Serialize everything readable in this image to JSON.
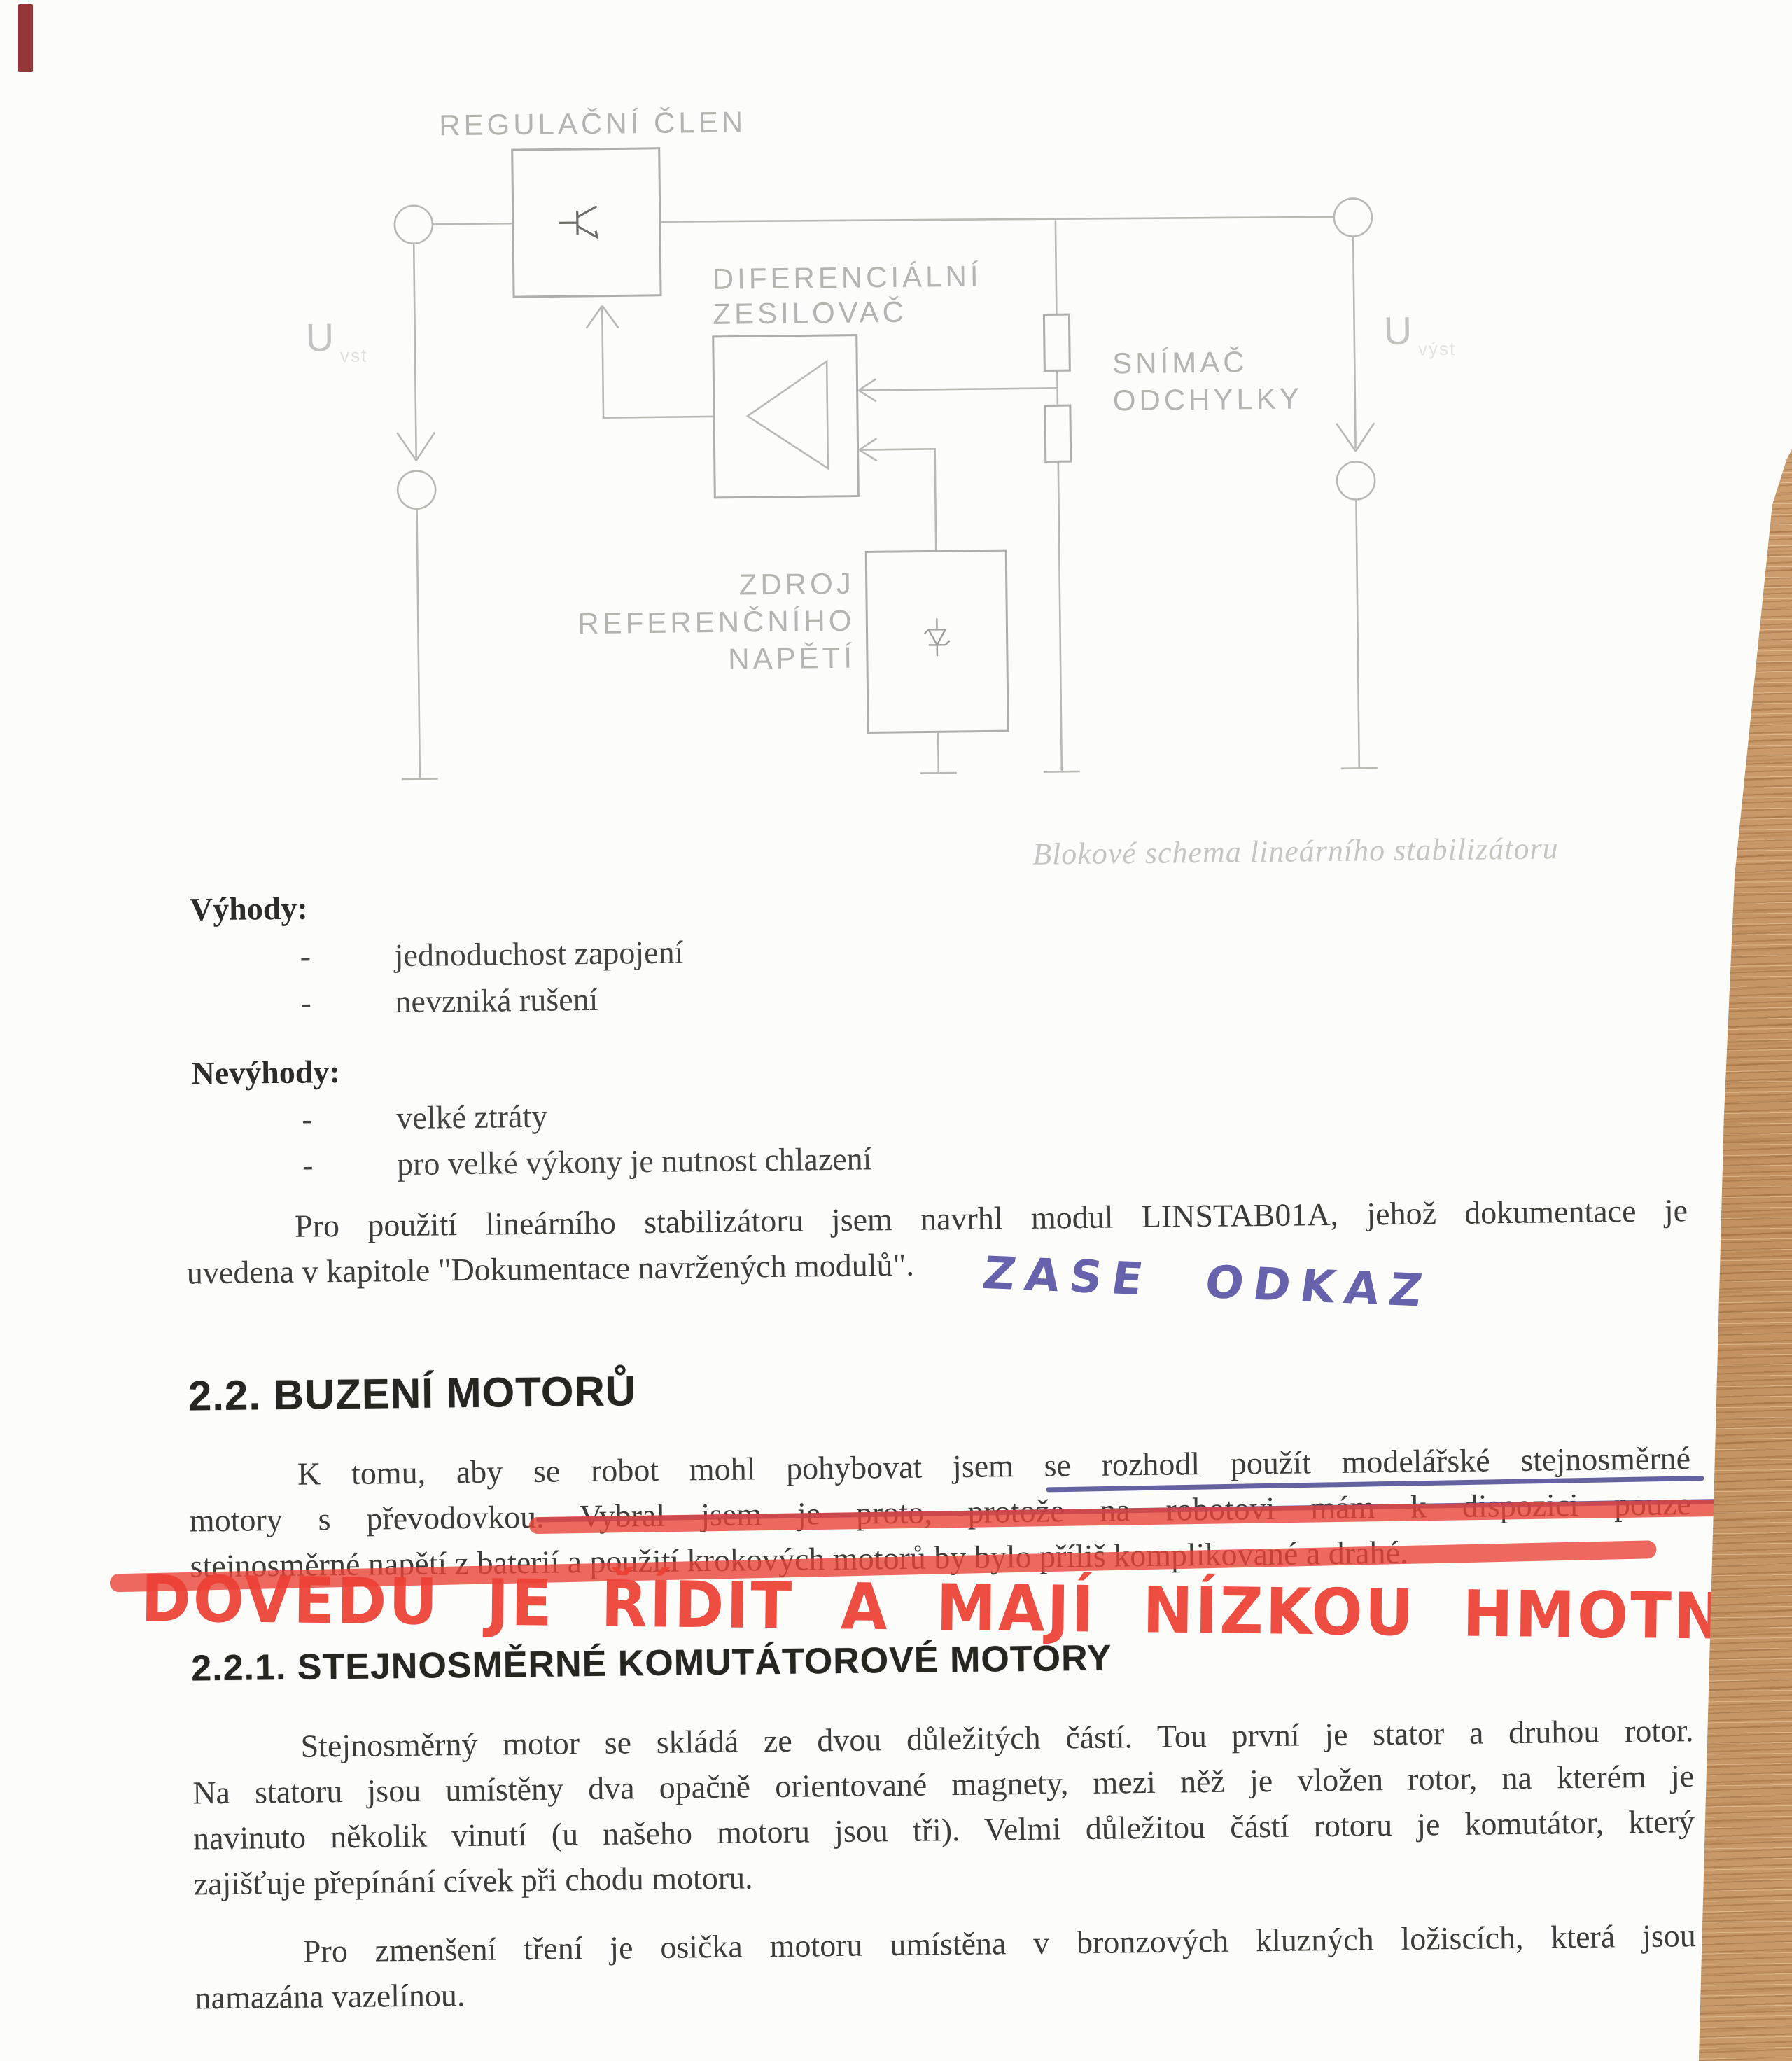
{
  "document": {
    "diagram": {
      "labels": {
        "regulator": "REGULAČNÍ ČLEN",
        "diff_amp_line1": "DIFERENCIÁLNÍ",
        "diff_amp_line2": "ZESILOVAČ",
        "sensor_line1": "SNÍMAČ",
        "sensor_line2": "ODCHYLKY",
        "ref_line1": "ZDROJ",
        "ref_line2": "REFERENČNÍHO",
        "ref_line3": "NAPĚTÍ",
        "u_input": "U",
        "u_input_sub": "vst",
        "u_output": "U",
        "u_output_sub": "výst",
        "caption": "Blokové schema lineárního stabilizátoru"
      },
      "stroke_color": "#b7b9b3"
    },
    "advantages": {
      "heading": "Výhody:",
      "dash": "-",
      "items": [
        "jednoduchost zapojení",
        "nevzniká rušení"
      ]
    },
    "disadvantages": {
      "heading": "Nevýhody:",
      "dash": "-",
      "items": [
        "velké ztráty",
        "pro velké výkony je nutnost chlazení"
      ]
    },
    "paragraph_linstab": {
      "lines": [
        "Pro použití lineárního stabilizátoru jsem navrhl modul LINSTAB01A, jehož dokumentace je",
        "uvedena v kapitole \"Dokumentace navržených modulů\"."
      ]
    },
    "annotations": {
      "blue_note": "ZASE ODKAZ",
      "red_note": "DOVEDU JE ŘÍDIT A MAJÍ NÍZKOU HMOTNOST",
      "blue_pen_color": "#5b55a6",
      "red_marker_color": "#ee4034"
    },
    "section_2_2": {
      "title": "2.2. BUZENÍ MOTORŮ"
    },
    "paragraph_motors": {
      "lines": [
        "K tomu, aby se robot mohl pohybovat jsem se rozhodl použít modelářské stejnosměrné",
        "motory s převodovkou. Vybral jsem je proto, protože na robotovi mám k dispozici pouze",
        "stejnosměrné napětí z baterií a použití krokových motorů by bylo příliš komplikované a drahé."
      ]
    },
    "section_2_2_1": {
      "title": "2.2.1. STEJNOSMĚRNÉ KOMUTÁTOROVÉ MOTORY"
    },
    "paragraph_dc_motor": {
      "lines": [
        "Stejnosměrný motor se skládá ze dvou důležitých částí. Tou první je stator a druhou rotor.",
        "Na statoru jsou umístěny dva opačně orientované magnety, mezi něž je vložen rotor, na kterém je",
        "navinuto několik vinutí (u našeho motoru jsou tři). Velmi důležitou částí rotoru je komutátor, který",
        "zajišťuje přepínání cívek při chodu motoru."
      ]
    },
    "paragraph_bearings": {
      "lines": [
        "Pro zmenšení tření je osička motoru umístěna v bronzových kluzných ložiscích, která jsou",
        "namazána vazelínou."
      ]
    }
  }
}
